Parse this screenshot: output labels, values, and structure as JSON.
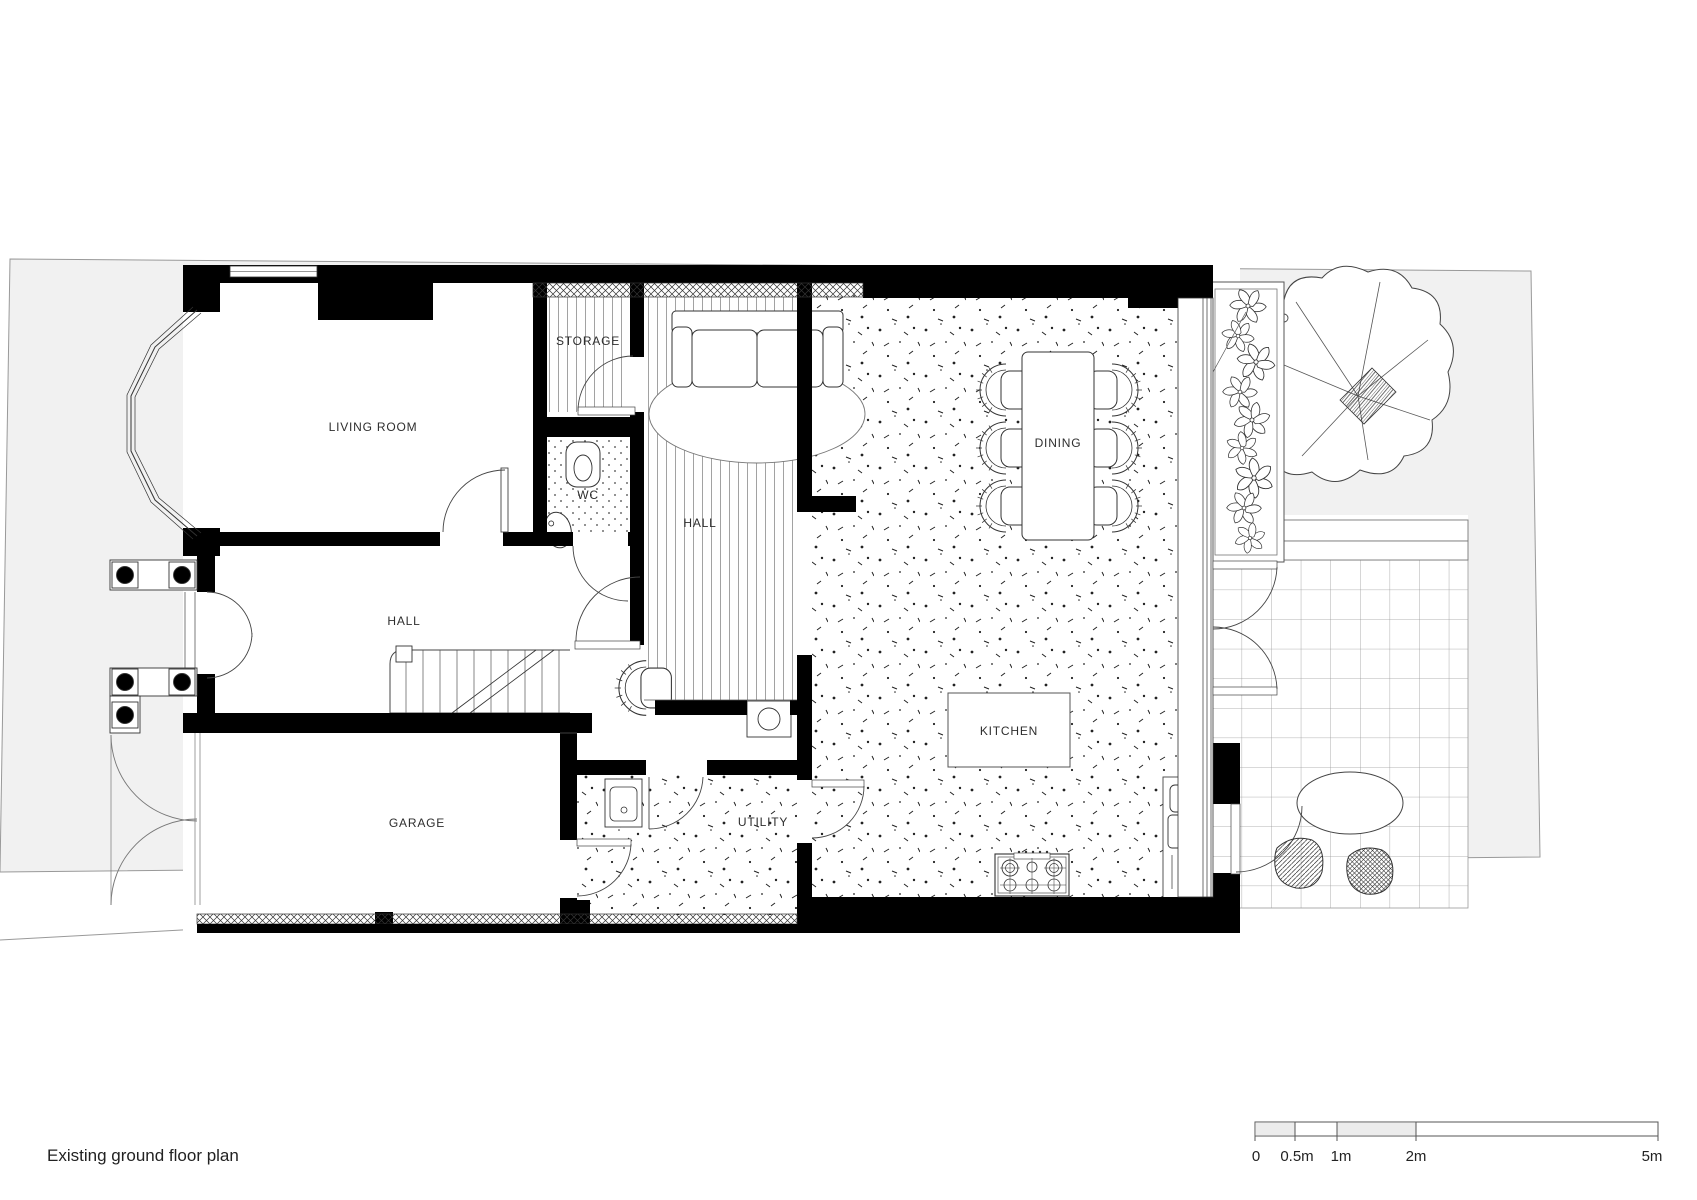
{
  "meta": {
    "caption": "Existing ground floor plan",
    "drawing_type": "floor-plan"
  },
  "rooms": [
    {
      "id": "living-room",
      "label": "LIVING ROOM"
    },
    {
      "id": "storage",
      "label": "STORAGE"
    },
    {
      "id": "wc",
      "label": "WC"
    },
    {
      "id": "hall-front",
      "label": "HALL"
    },
    {
      "id": "hall-rear",
      "label": "HALL"
    },
    {
      "id": "dining",
      "label": "DINING"
    },
    {
      "id": "kitchen",
      "label": "KITCHEN"
    },
    {
      "id": "garage",
      "label": "GARAGE"
    },
    {
      "id": "utility",
      "label": "UTILITY"
    }
  ],
  "scale_bar": {
    "labels": [
      "0",
      "0.5m",
      "1m",
      "2m",
      "5m"
    ]
  },
  "colors": {
    "site": "#f1f1f1",
    "wall": "#000000",
    "line": "#333333",
    "light_line": "#888888"
  }
}
